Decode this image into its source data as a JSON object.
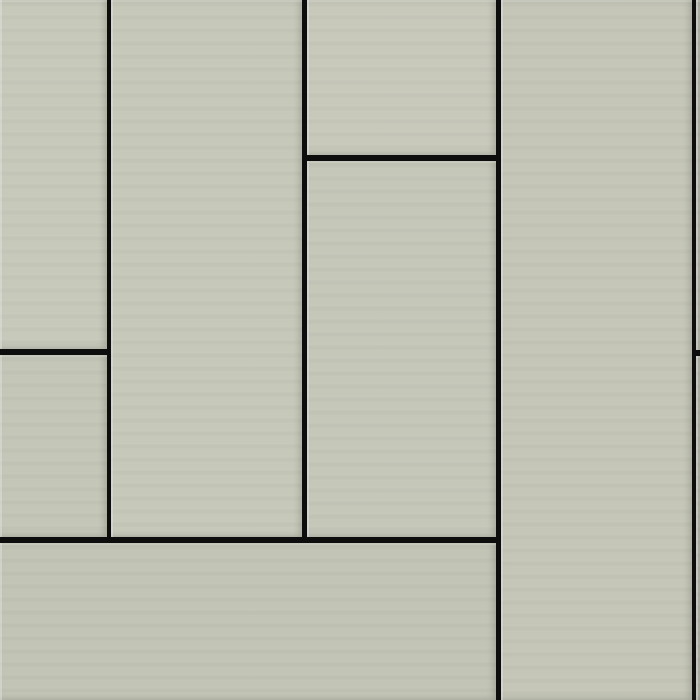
{
  "texture": {
    "description": "staggered vertical wood-panel cladding texture",
    "pattern_type": "staggered-vertical-planks",
    "canvas": {
      "width": 700,
      "height": 700
    },
    "colors": {
      "grout": "#0d0d0d",
      "plank_base": "#c5c7b9",
      "edge_highlight": "#d8dacb"
    },
    "grout_lines": {
      "vertical": [
        {
          "x": 107,
          "width": 4,
          "y1": 0,
          "y2": 543
        },
        {
          "x": 302,
          "width": 5,
          "y1": 0,
          "y2": 543
        },
        {
          "x": 496,
          "width": 5,
          "y1": 0,
          "y2": 700
        },
        {
          "x": 692,
          "width": 4,
          "y1": 0,
          "y2": 700
        }
      ],
      "horizontal": [
        {
          "y": 155,
          "height": 6,
          "x1": 307,
          "x2": 496
        },
        {
          "y": 349,
          "height": 6,
          "x1": 0,
          "x2": 107
        },
        {
          "y": 350,
          "height": 6,
          "x1": 696,
          "x2": 700
        },
        {
          "y": 537,
          "height": 6,
          "x1": 0,
          "x2": 496
        }
      ]
    },
    "planks": [
      {
        "name": "plank-left-top",
        "x": 0,
        "y": 0,
        "w": 107,
        "h": 349,
        "fill": "#c7c9bb"
      },
      {
        "name": "plank-left-middle",
        "x": 0,
        "y": 355,
        "w": 107,
        "h": 182,
        "fill": "#c4c6b8"
      },
      {
        "name": "plank-col2-tall",
        "x": 111,
        "y": 0,
        "w": 191,
        "h": 537,
        "fill": "#c6c8ba"
      },
      {
        "name": "plank-col3-top",
        "x": 307,
        "y": 0,
        "w": 189,
        "h": 155,
        "fill": "#c8c9bb"
      },
      {
        "name": "plank-col3-middle",
        "x": 307,
        "y": 161,
        "w": 189,
        "h": 376,
        "fill": "#c5c7b9"
      },
      {
        "name": "plank-bottom-wide",
        "x": 0,
        "y": 543,
        "w": 496,
        "h": 157,
        "fill": "#c2c4b6"
      },
      {
        "name": "plank-col4-full",
        "x": 501,
        "y": 0,
        "w": 191,
        "h": 700,
        "fill": "#c5c6b8"
      },
      {
        "name": "plank-right-sliver-top",
        "x": 696,
        "y": 0,
        "w": 4,
        "h": 350,
        "fill": "#c0c2b4"
      },
      {
        "name": "plank-right-sliver-bottom",
        "x": 696,
        "y": 356,
        "w": 4,
        "h": 344,
        "fill": "#bfc1b3"
      }
    ]
  }
}
